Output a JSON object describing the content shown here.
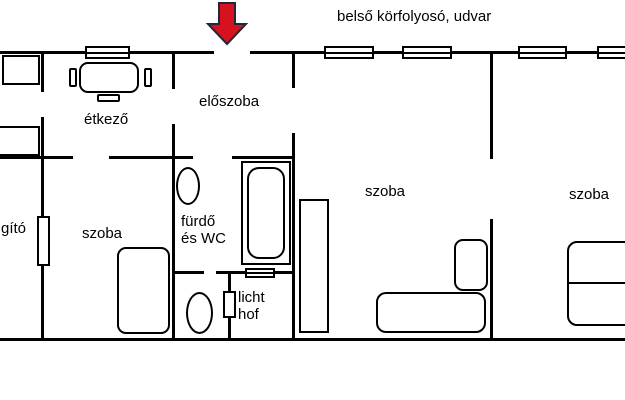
{
  "header": {
    "corridor_label": "belső körfolyosó, udvar"
  },
  "rooms": {
    "entry_hall": "előszoba",
    "dining_room": "étkező",
    "room_left": "szoba",
    "room_middle": "szoba",
    "room_right": "szoba",
    "bathroom_line1": "fürdő",
    "bathroom_line2": "és WC",
    "light_well_line1": "licht",
    "light_well_line2": "hof",
    "left_edge_text_fragment": "gító"
  },
  "icons": {
    "entrance_arrow": "red-down-arrow"
  },
  "colors": {
    "arrow_fill": "#d6121f",
    "arrow_outline": "#26263a",
    "line": "#000000",
    "background": "#ffffff"
  }
}
